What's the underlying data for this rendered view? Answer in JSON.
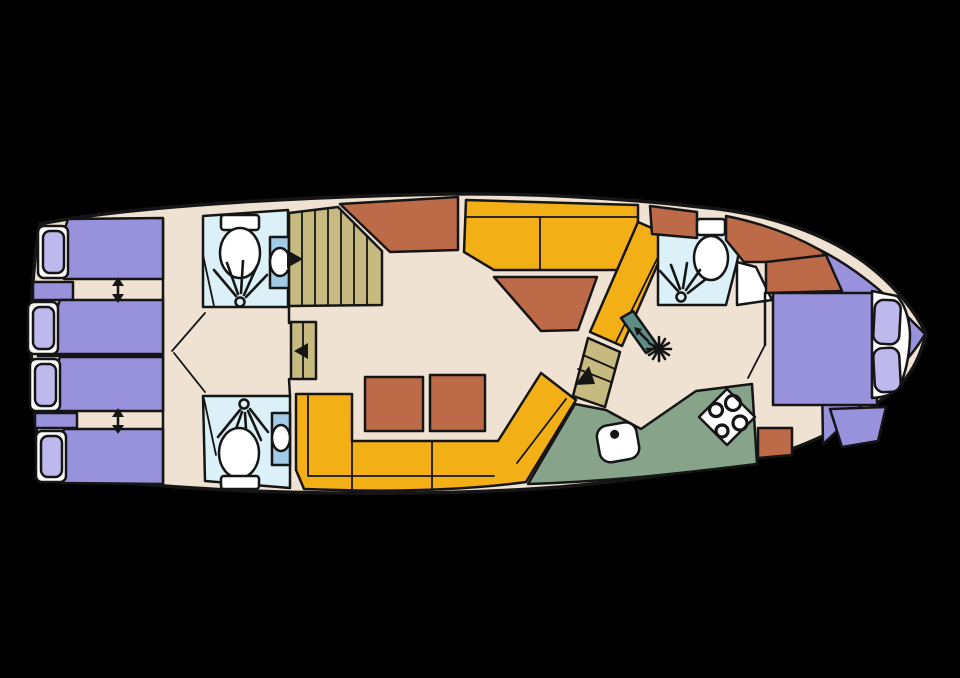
{
  "figure": {
    "type": "boat-floor-plan",
    "description": "Deck plan of a motor yacht, bow to the right, drawn on a black background"
  },
  "palette": {
    "background": "#000000",
    "floor": "#EFE2D2",
    "outline": "#151515",
    "bed": "#9792DB",
    "pillow": "#BEB9EC",
    "white": "#FFFFFF",
    "bathroom": "#DBF0F7",
    "basin": "#A2CCE5",
    "sofa": "#F3B016",
    "terracotta": "#BD6A49",
    "stairs": "#C6BA80",
    "galley": "#87A389",
    "fridge": "#5E8C86"
  },
  "icons": {
    "toilet": "oval-bowl-with-cistern",
    "shower": "spray-rays-from-head",
    "washbasin": "oval-in-rectangle",
    "stove": "diamond-with-4-burners",
    "sink": "rounded-square-with-drain-dot",
    "fridge": "snowflake",
    "companionway_arrow": "solid-triangle",
    "bed_convert_arrow": "double-headed-vertical-arrow"
  },
  "inventory": {
    "single_beds": 4,
    "double_beds": 1,
    "bathrooms": 3,
    "showers": 3,
    "toilets": 3,
    "washbasins": 2,
    "sofas": 2,
    "tables": 3,
    "stairways": 3,
    "stove_burners": 4,
    "sinks": 1
  }
}
